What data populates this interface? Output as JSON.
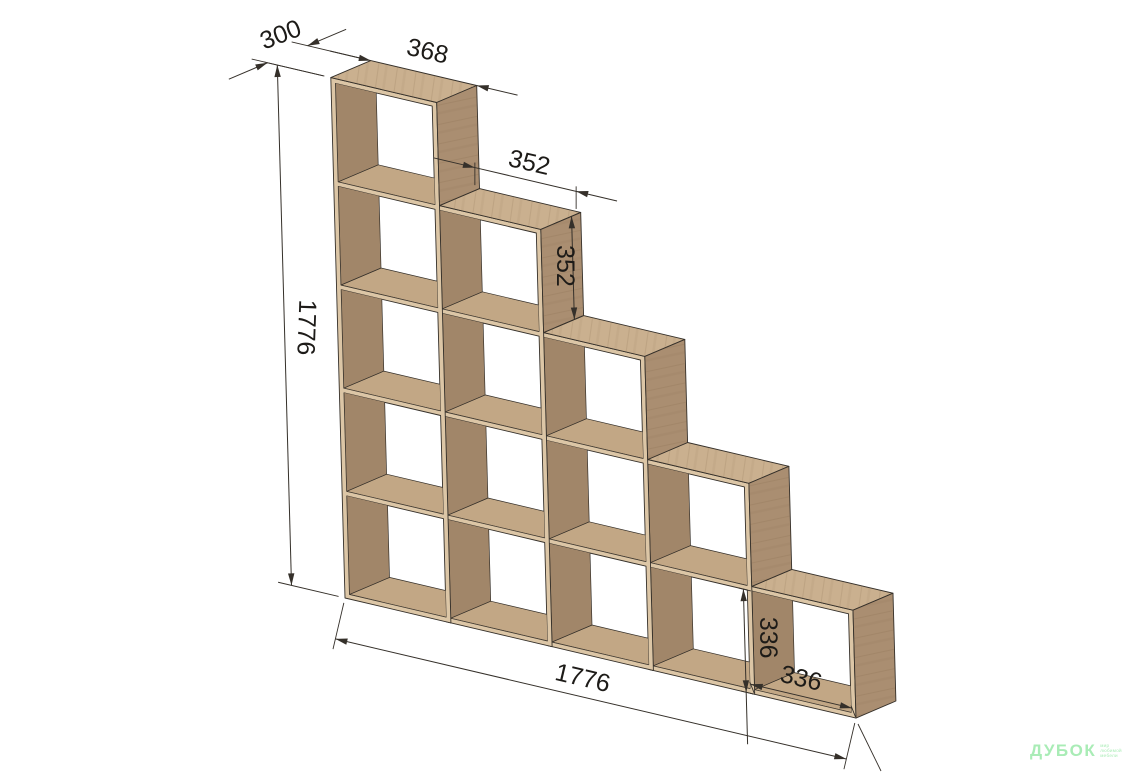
{
  "diagram": {
    "type": "furniture-dimension-drawing",
    "subject": "staircase cube shelving unit, 5 steps, 15 open cubes",
    "unit": "mm",
    "structure": {
      "columns": 5,
      "column_heights_cubes": [
        5,
        4,
        3,
        2,
        1
      ],
      "cube_pitch_mm": 352,
      "opening_mm": 336,
      "panel_thickness_mm": 16,
      "total_width_mm": 1776,
      "total_height_mm": 1776,
      "depth_mm": 300
    },
    "dimensions": [
      {
        "id": "depth",
        "label": "300"
      },
      {
        "id": "top-cube-width",
        "label": "368"
      },
      {
        "id": "step-width",
        "label": "352"
      },
      {
        "id": "step-height",
        "label": "352"
      },
      {
        "id": "total-height",
        "label": "1776"
      },
      {
        "id": "total-width",
        "label": "1776"
      },
      {
        "id": "end-cube-height",
        "label": "336"
      },
      {
        "id": "end-cube-width",
        "label": "336"
      }
    ],
    "colors": {
      "background": "#ffffff",
      "wood_top": "#cab08f",
      "wood_front": "#dcc6a6",
      "wood_side": "#aa8e71",
      "wood_interior": "#a18669",
      "wood_floor": "#c2a785",
      "line": "#35302a",
      "dim_text": "#1d1b18",
      "watermark_green": "#a9ecb6"
    }
  },
  "watermark": {
    "brand": "ДУБОК",
    "tagline_lines": [
      "мир",
      "любимой",
      "мебели"
    ]
  }
}
